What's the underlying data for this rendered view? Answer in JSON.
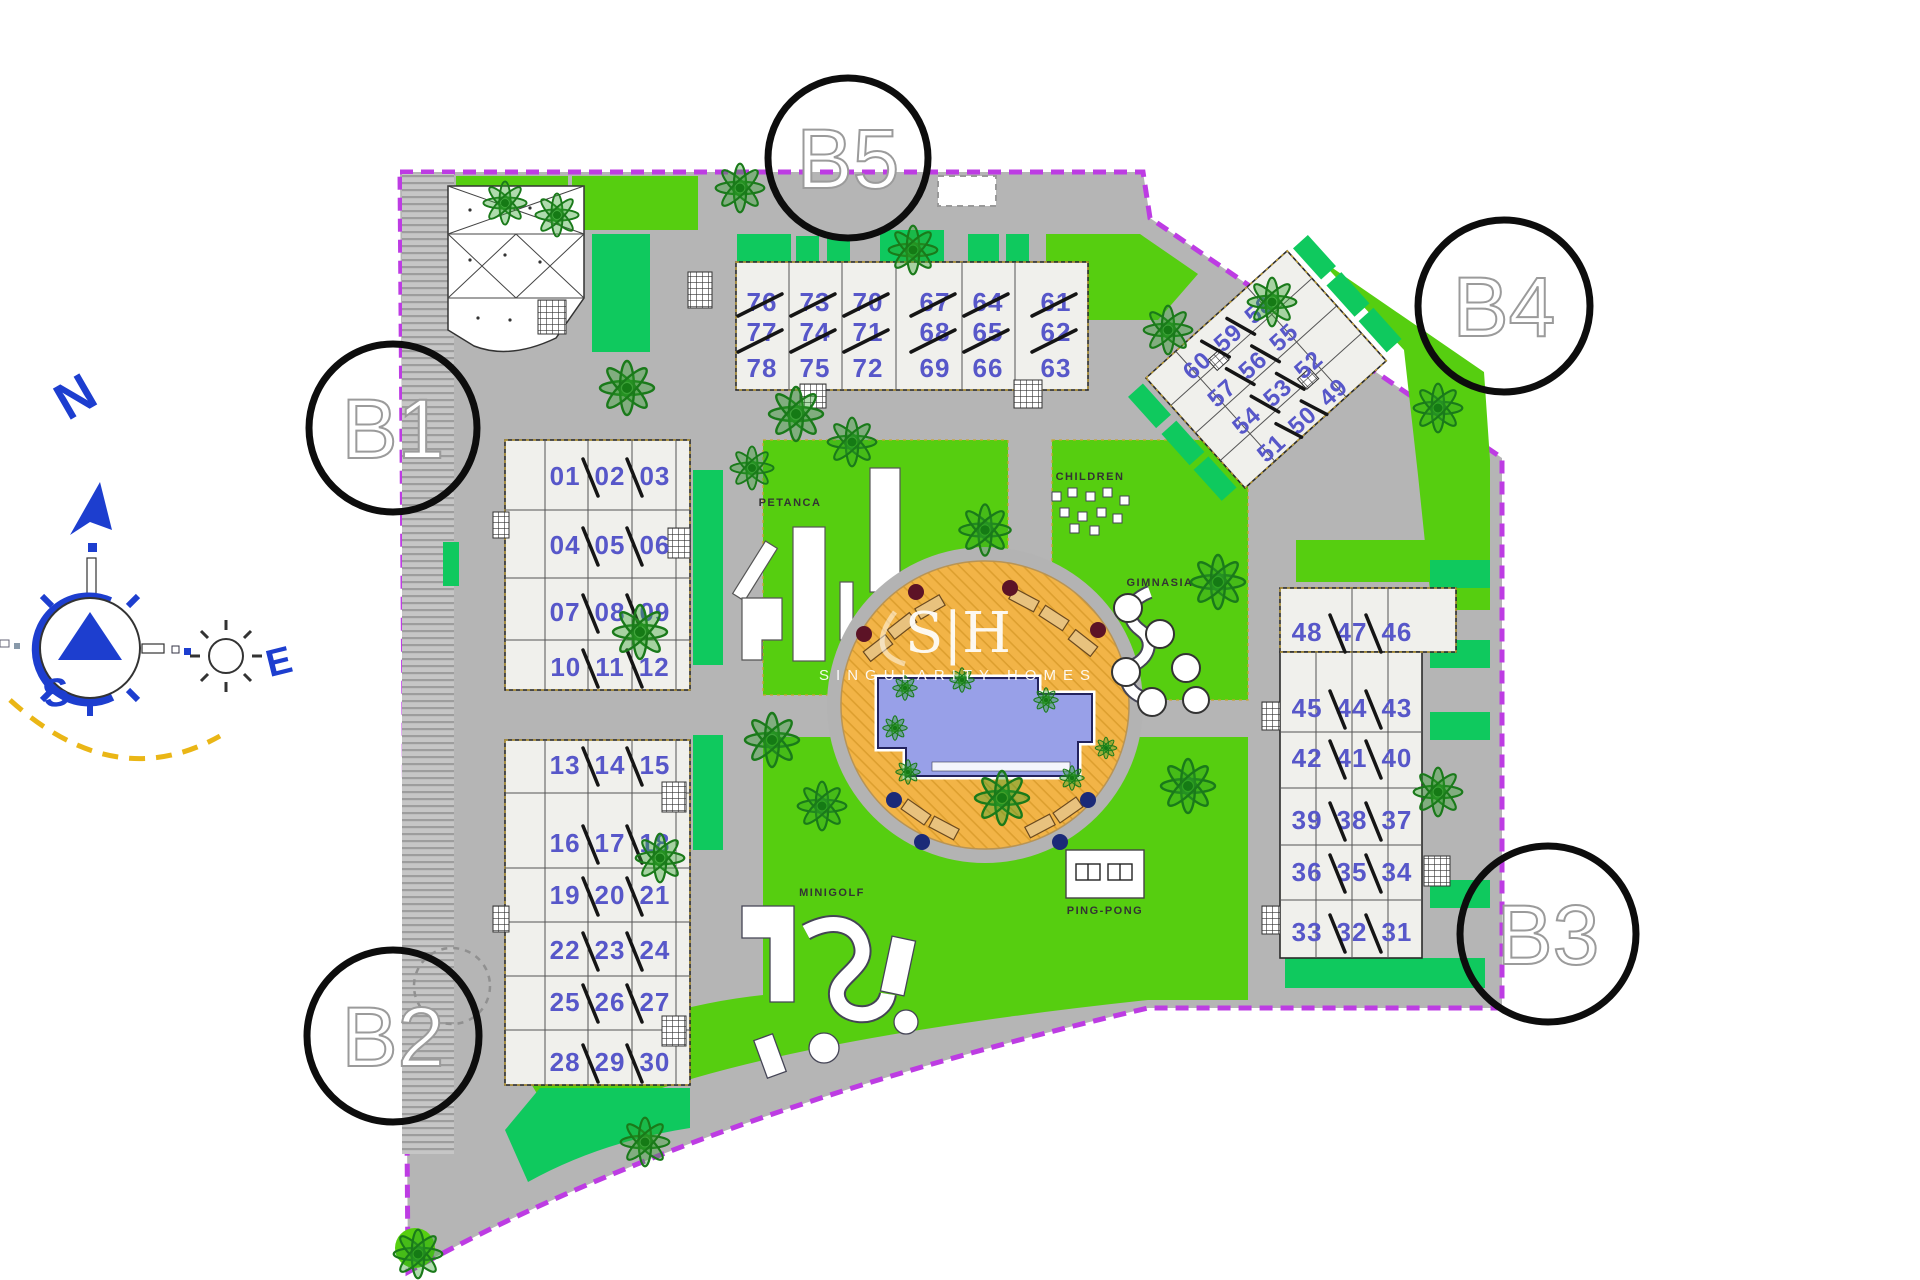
{
  "watermark": {
    "monogram": "S|H",
    "brand": "SINGULARITY HOMES"
  },
  "compass": {
    "n": "N",
    "e": "E",
    "s": "S"
  },
  "amenities": {
    "petanca": "PETANCA",
    "children": "CHILDREN",
    "gym": "GIMNASIA",
    "minigolf": "MINIGOLF",
    "pingpong": "PING-PONG"
  },
  "blocks": {
    "b1": {
      "label": "B1",
      "upper_rows": [
        [
          "01",
          "02",
          "03"
        ],
        [
          "04",
          "05",
          "06"
        ],
        [
          "07",
          "08",
          "09"
        ],
        [
          "10",
          "11",
          "12"
        ]
      ],
      "lower_rows": [
        [
          "13",
          "14",
          "15"
        ],
        [
          "16",
          "17",
          "18"
        ],
        [
          "19",
          "20",
          "21"
        ],
        [
          "22",
          "23",
          "24"
        ],
        [
          "25",
          "26",
          "27"
        ],
        [
          "28",
          "29",
          "30"
        ]
      ]
    },
    "b2": {
      "label": "B2"
    },
    "b3": {
      "label": "B3",
      "rows": [
        [
          "48",
          "47",
          "46"
        ],
        [
          "45",
          "44",
          "43"
        ],
        [
          "42",
          "41",
          "40"
        ],
        [
          "39",
          "38",
          "37"
        ],
        [
          "36",
          "35",
          "34"
        ],
        [
          "33",
          "32",
          "31"
        ]
      ]
    },
    "b4": {
      "label": "B4",
      "rows": [
        [
          "60",
          "59",
          "58"
        ],
        [
          "57",
          "56",
          "55"
        ],
        [
          "54",
          "53",
          "52"
        ],
        [
          "51",
          "50",
          "49"
        ]
      ]
    },
    "b5": {
      "label": "B5",
      "columns": [
        [
          "76",
          "77",
          "78"
        ],
        [
          "73",
          "74",
          "75"
        ],
        [
          "70",
          "71",
          "72"
        ],
        [
          "67",
          "68",
          "69"
        ],
        [
          "64",
          "65",
          "66"
        ],
        [
          "61",
          "62",
          "63"
        ]
      ]
    }
  },
  "colors": {
    "boundary": "#bd3ce3",
    "lawn": "#56ce10",
    "lawn_dark": "#0fc95e",
    "pavement": "#b5b5b5",
    "deck": "#f2b447",
    "pool": "#98a0e8",
    "unit_number": "#5757c9",
    "compass_blue": "#1d3ecf"
  }
}
